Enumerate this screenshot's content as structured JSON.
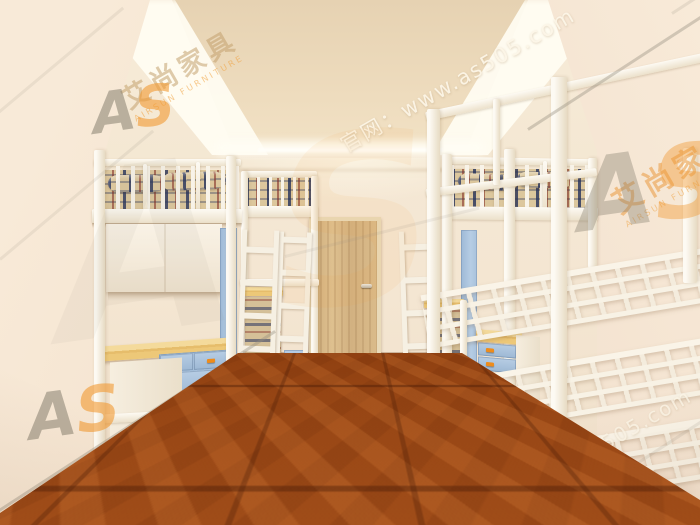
{
  "watermark": {
    "site_label": "官网：www.as505.com",
    "brand_cn": "艾尚家具",
    "brand_en": "AIRSUN FURNITURE",
    "logo_a": "A",
    "logo_s": "S"
  },
  "scene": {
    "colors": {
      "wall": "#f4e8d6",
      "ceiling_recess": "#ecd9ba",
      "cove_glow": "#fffdf4",
      "floor_wood": "#b4591d",
      "bed_frame_white": "#f8f2e6",
      "desk_wood": "#ecc878",
      "drawer_blue": "#a3bdd8",
      "handle_orange": "#ee8c1c",
      "bedding_base": "#dcc79d",
      "bedding_stripe_navy": "#23305a",
      "bedding_stripe_red": "#7d231e",
      "door_wood": "#d9ba8a",
      "watermark_orange": "#f29932",
      "watermark_gray": "#87796f"
    }
  }
}
